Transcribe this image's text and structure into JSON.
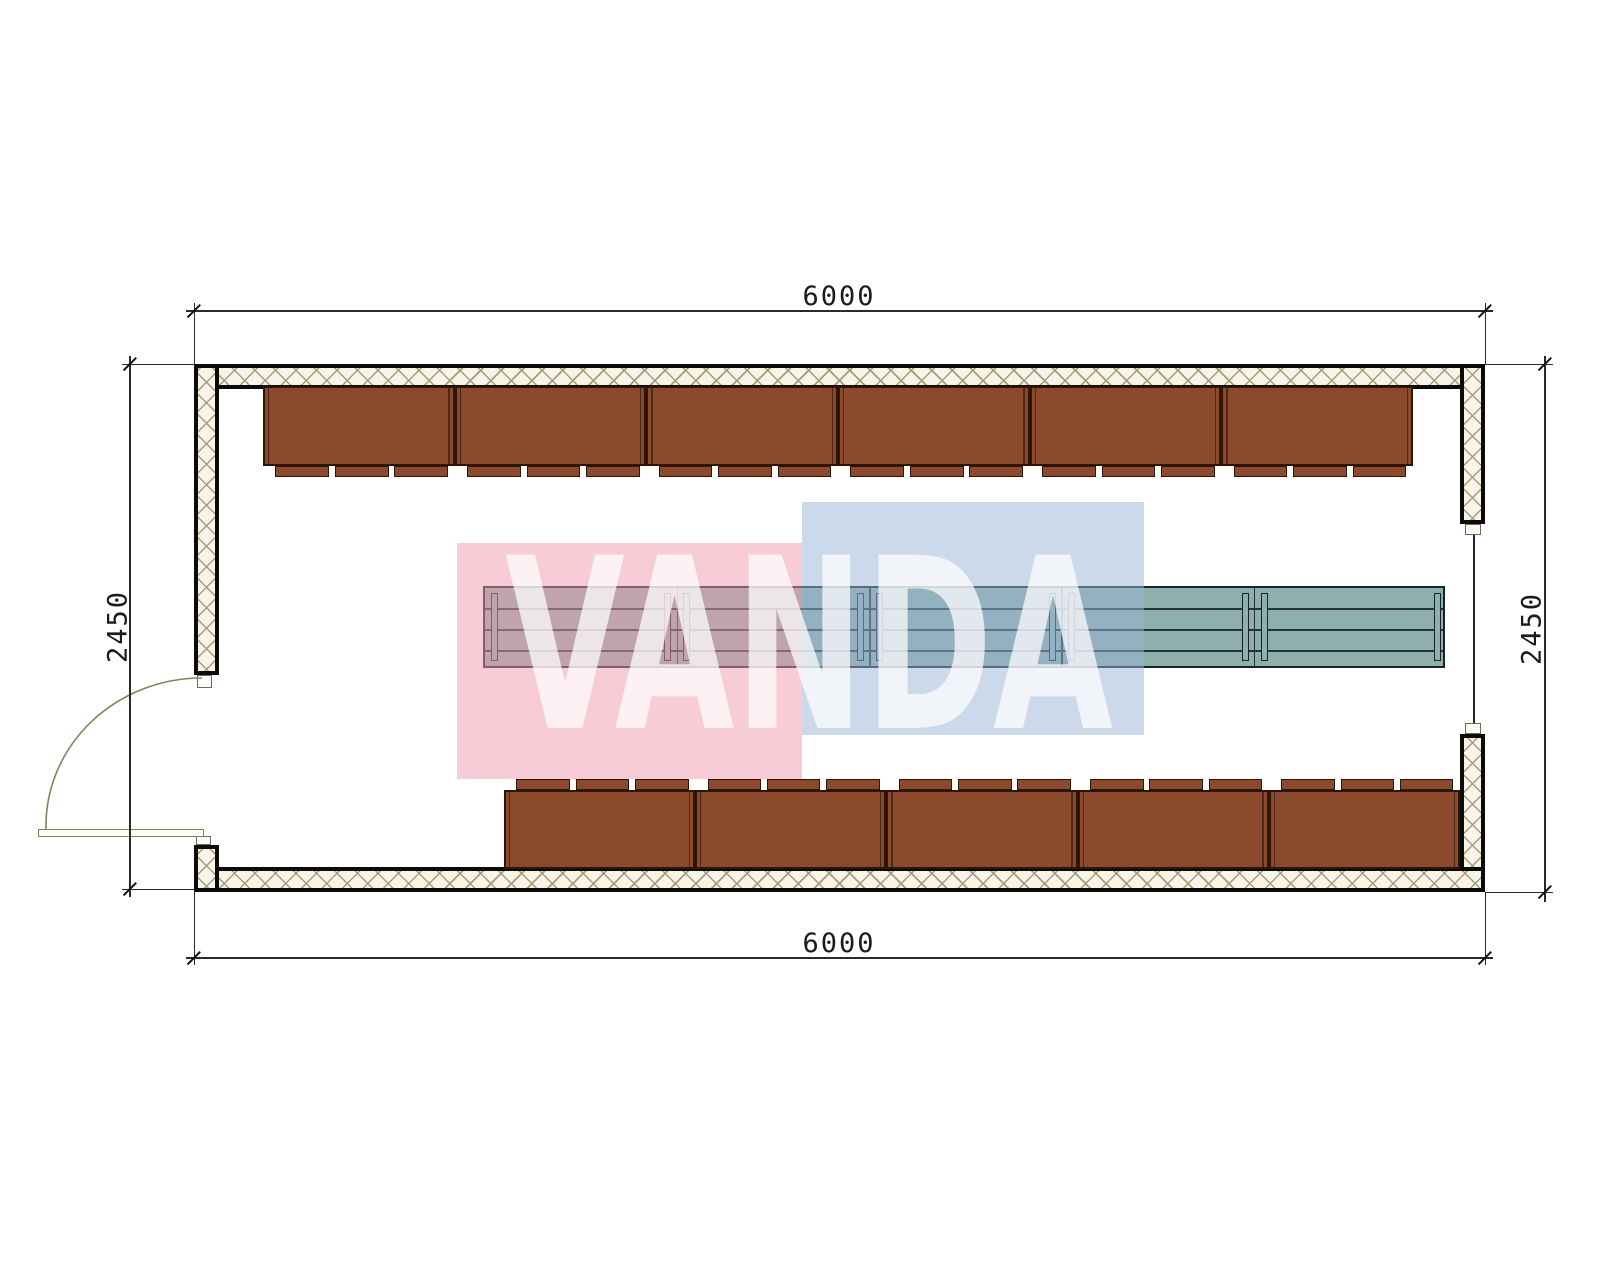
{
  "drawing": {
    "type": "floor-plan",
    "dimensions": {
      "top": "6000",
      "bottom": "6000",
      "left": "2450",
      "right": "2450"
    },
    "watermark": {
      "text": "VANDA",
      "pink_color": "rgba(239,154,176,0.5)",
      "blue_color": "rgba(153,179,213,0.5)",
      "text_color": "#ffffff",
      "text_opacity": 0.72
    },
    "furniture": {
      "top_bench_count": 6,
      "bottom_bench_count": 5,
      "tabs_per_bench": 3,
      "bench_color": "#8a4a2b",
      "table_segment_count": 5,
      "table_color": "#8fafac"
    },
    "wall": {
      "hatch_bg": "#f8f5e8",
      "hatch_line": "#a59c79"
    }
  }
}
